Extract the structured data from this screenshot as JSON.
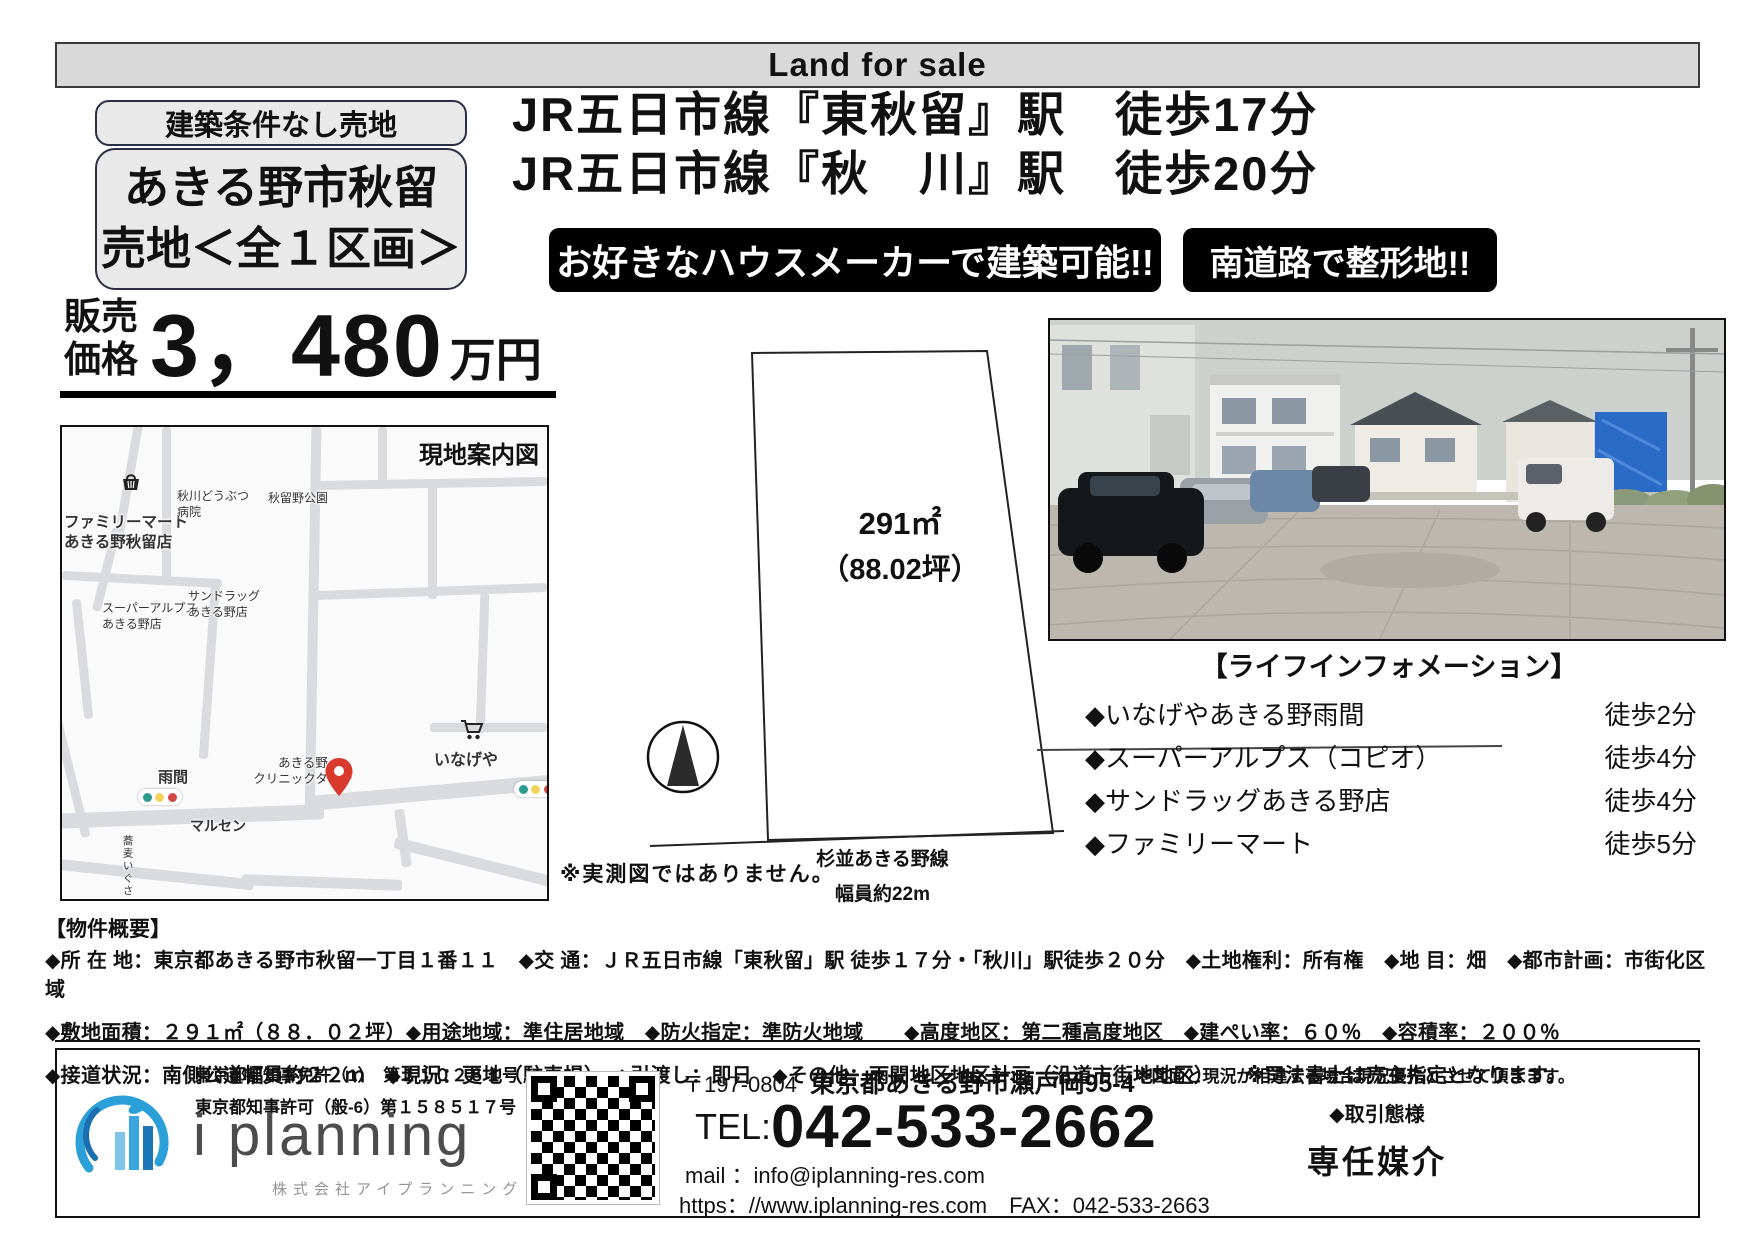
{
  "top_banner": {
    "text": "Land for sale"
  },
  "badges": {
    "condition": "建築条件なし売地",
    "city": "あきる野市秋留",
    "lot": "売地＜全１区画＞"
  },
  "headlines": {
    "line1": "JR五日市線『東秋留』駅　徒歩17分",
    "line2": "JR五日市線『秋　川』駅　徒歩20分"
  },
  "ribbons": {
    "left": "お好きなハウスメーカーで建築可能!!",
    "right": "南道路で整形地!!"
  },
  "price": {
    "label1": "販売",
    "label2": "価格",
    "amount": "3，480",
    "unit": "万円"
  },
  "map": {
    "title": "現地案内図",
    "labels": {
      "vet": "秋川どうぶつ\n病院",
      "park": "秋留野公園",
      "familymart": "ファミリーマート\nあきる野秋留店",
      "superalps": "スーパーアルプス\nあきる野店",
      "sundrug": "サンドラッグ\nあきる野店",
      "amema": "雨間",
      "clinic": "あきる野\nクリニックタウン",
      "inageya": "いなげや",
      "marusen": "マルセン",
      "soba": "蕎麦いぐさ"
    }
  },
  "plot": {
    "area": "291㎡",
    "tsubo": "（88.02坪）",
    "note": "※実測図ではありません。",
    "road_name": "杉並あきる野線",
    "road_width": "幅員約22m"
  },
  "life_info": {
    "title": "【ライフインフォメーション】",
    "items": [
      {
        "name": "◆いなげやあきる野雨間",
        "time": "徒歩2分"
      },
      {
        "name": "◆スーパーアルプス（コピオ）",
        "time": "徒歩4分"
      },
      {
        "name": "◆サンドラッグあきる野店",
        "time": "徒歩4分"
      },
      {
        "name": "◆ファミリーマート",
        "time": "徒歩5分"
      }
    ]
  },
  "overview": {
    "title": "【物件概要】",
    "lines": [
      "◆所 在 地：東京都あきる野市秋留一丁目１番１１　◆交 通：ＪＲ五日市線「東秋留」駅 徒歩１７分・「秋川」駅徒歩２０分　◆土地権利：所有権　◆地 目：畑　◆都市計画：市街化区域",
      "◆敷地面積：２９１㎡（８８．０２坪）◆用途地域：準住居地域　◆防火指定：準防火地域　　◆高度地区：第二種高度地区　◆建ぺい率：６０％　◆容積率：２００％",
      "◆接道状況：南側公道幅員約２２ｍ　◆現況：更地（駐車場）　◆引渡し：即日　◆その他：雨間地区地区計画（沿道市街地地区）　　※司法書士は売主指定となります。"
    ]
  },
  "footer": {
    "license1": "東京都都知事免許（1）　第１１０２６１号",
    "license2": "東京都知事許可（般-6）第１５８５１７号",
    "company_en": "i planning",
    "company_jp": "株式会社アイプランニング",
    "postal": "〒197-0804",
    "address": "東京都あきる野市瀬戸岡95-4",
    "tel_label": "TEL:",
    "tel": "042-533-2662",
    "mail_line": "mail ：info@iplanning-res.com",
    "web_line": "https：//www.iplanning-res.com　FAX：042-533-2663",
    "note": "※図面と現況が相違する場合現況優先とさせて頂きます。",
    "deal_label": "◆取引態様",
    "deal_value": "専任媒介"
  },
  "icons": {
    "basket": "store-basket shape",
    "cart": "shopping-cart shape",
    "traffic_light": "three-dot pill",
    "map_pin": "red teardrop",
    "north_arrow": "circle + triangle"
  },
  "colors": {
    "ribbon_bg": "#000000",
    "ribbon_text": "#ffffff",
    "header_bar_bg": "#d9d9d9",
    "map_road": "#d9dbde",
    "pin_red": "#d93a2d",
    "traffic_green": "#2a9d8f",
    "traffic_yellow": "#f2d35c",
    "traffic_red": "#d64545",
    "logo_blue": "#2a9fd8"
  }
}
